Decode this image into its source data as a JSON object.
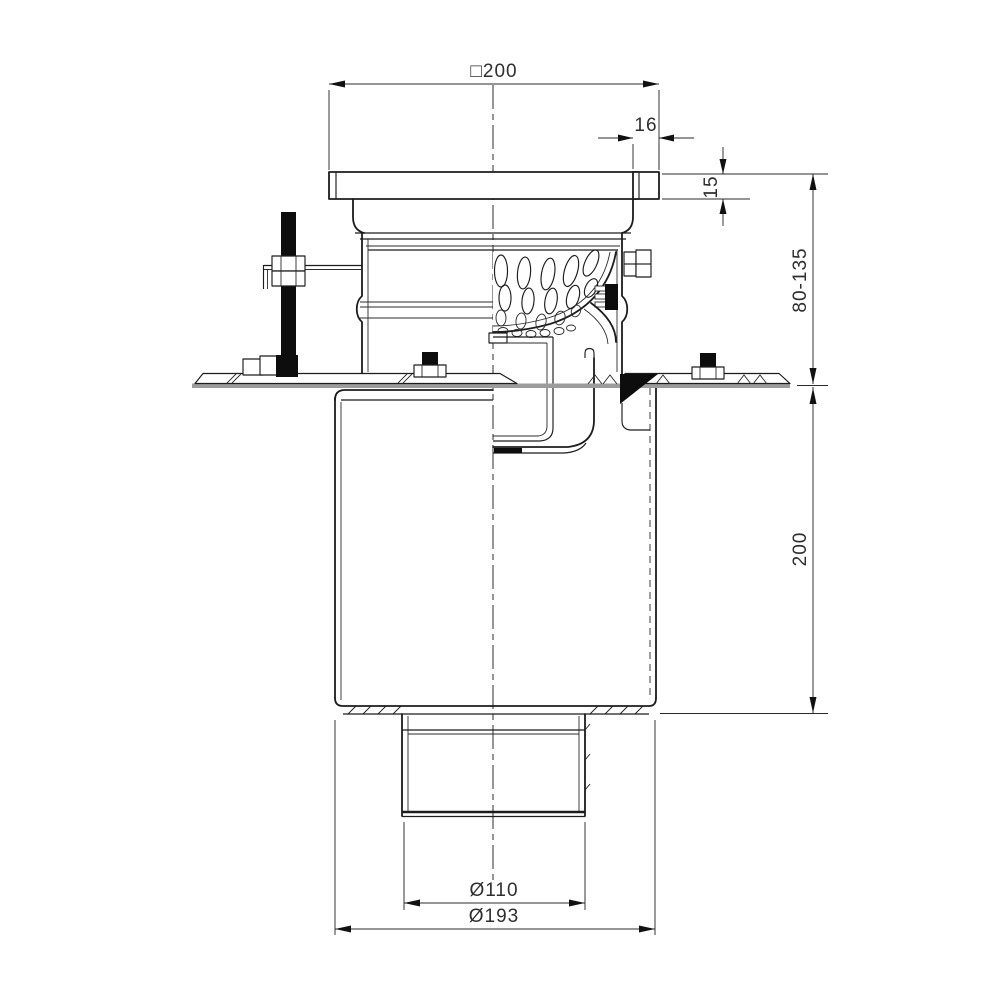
{
  "drawing": {
    "type": "engineering cross-section",
    "subject": "floor drain with clamping flange and vertical outlet",
    "labels": {
      "square_width": "□200",
      "edge_width": "16",
      "flange_height": "15",
      "adjust_range": "80-135",
      "body_height": "200",
      "outlet_diameter": "Ø110",
      "body_diameter": "Ø193"
    },
    "colors": {
      "line": "#1c1c1c",
      "dim_text": "#2e2e2e",
      "membrane": "#9c9c9c",
      "black_fill": "#0d0d0d",
      "background": "#ffffff"
    }
  }
}
